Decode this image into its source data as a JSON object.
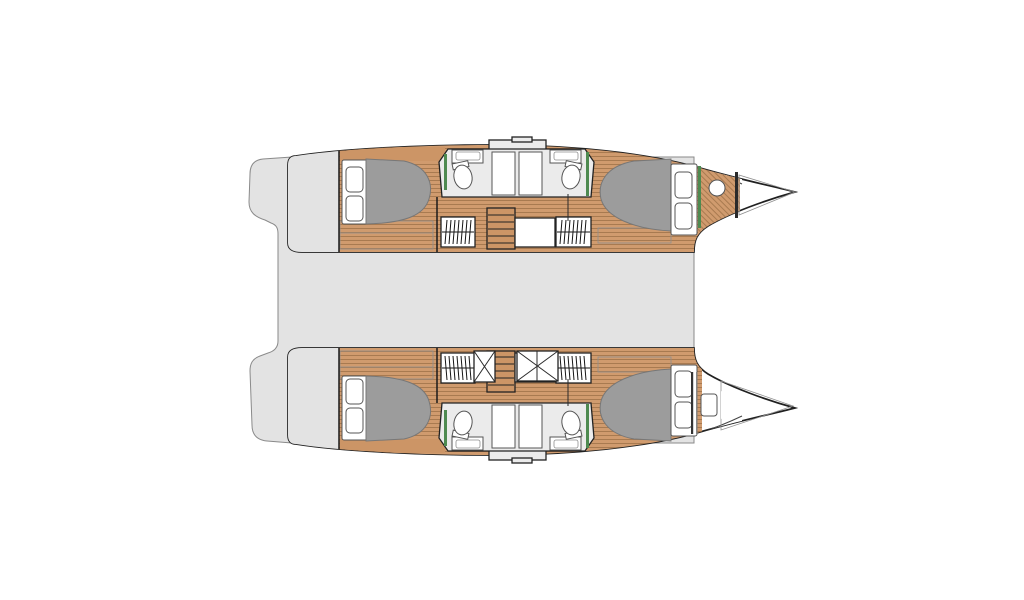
{
  "meta": {
    "title": "Catamaran interior deck plan",
    "diagram_type": "boat floor plan, top-down view",
    "orientation": "bow pointing right, two parallel hulls joined by a central bridgedeck",
    "text_labels": []
  },
  "colors": {
    "background": "#ffffff",
    "deck": "#e3e3e3",
    "deck_outline": "#8a8a8a",
    "hull_fill": "#ffffff",
    "hull_outline": "#202020",
    "wood": "#d09b6e",
    "wood_stripe": "#a87a50",
    "wood_solid": "#cc9566",
    "bed": "#9c9c9c",
    "bed_outline": "#777777",
    "pillow": "#ffffff",
    "bathroom": "#ebebeb",
    "shower": "#f5f5f5",
    "fixture_outline": "#555555",
    "wall": "#1a1a1a",
    "accent_green": "#4e8a50",
    "bow_tip_light": "#dcdcdc",
    "bow_tip_dark": "#ababab"
  },
  "layout": {
    "bridgedeck": {
      "description": "central gray bridgedeck / saloon-cockpit platform with stepped transom edge aft (left side)"
    },
    "hulls": [
      {
        "id": "port-hull",
        "position": "top",
        "rooms": [
          "aft double cabin with island bed and two pillows",
          "en-suite bathroom block with toilet, washbasin and shower stall",
          "two hanging lockers",
          "companionway stairs down from saloon",
          "forward double cabin with island bed and two pillows",
          "forepeak with round washbasin and diagonal-plank sole",
          "pointed bow locker"
        ]
      },
      {
        "id": "starboard-hull",
        "position": "bottom",
        "rooms": [
          "aft double cabin with island bed and two pillows",
          "en-suite bathroom block with toilet, washbasin and shower stall",
          "two hanging lockers",
          "companionway stairs down from saloon",
          "two cross-marked shower / hatch trays",
          "forward double cabin with island bed and two pillows",
          "forepeak with deck hatch",
          "pointed bow locker with dark anchor-well wedge"
        ]
      }
    ],
    "fixtures": {
      "double_beds": 4,
      "pillows": 8,
      "toilets": 4,
      "washbasins": 4,
      "shower_stalls": 4,
      "hanging_lockers": 4,
      "stairways": 2,
      "cross_marked_trays": 2,
      "bow_lockers": 2
    }
  }
}
